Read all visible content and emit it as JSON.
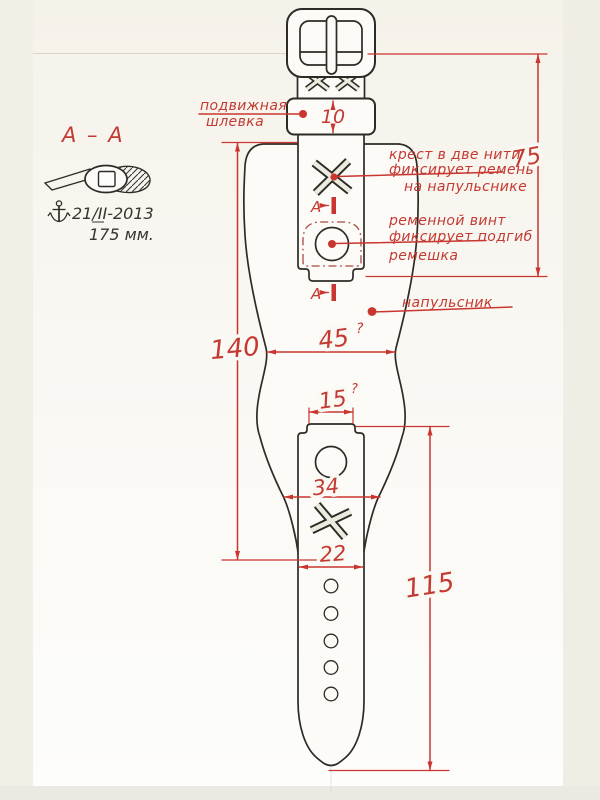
{
  "colors": {
    "annotation_red": "#c9362f",
    "drawing_black": "#2e2b27",
    "paper": "#fbfaf6",
    "scan_edge": "#efede4"
  },
  "section_view": {
    "title": "А – А",
    "date_note": "21/II-2013",
    "length_note": "175 мм."
  },
  "annotations": {
    "keeper": {
      "line1": "подвижная",
      "line2": "шлевка"
    },
    "cross": {
      "line1": "крест в две нити",
      "line2": "фиксирует ремень",
      "line3": "на напульснике"
    },
    "screw": {
      "line1": "ременной винт",
      "line2": "фиксирует подгиб",
      "line3": "ремешка"
    },
    "cuff_label": "напульсник",
    "section_cut": "A"
  },
  "dimensions": {
    "keeper_height": "10",
    "upper_strap_length": "75",
    "cuff_length": "140",
    "cuff_width": "45",
    "cuff_width_mark": "?",
    "tab_width": "15",
    "tab_width_mark": "?",
    "cuff_end_width": "34",
    "strap_width": "22",
    "lower_strap_length": "115"
  }
}
